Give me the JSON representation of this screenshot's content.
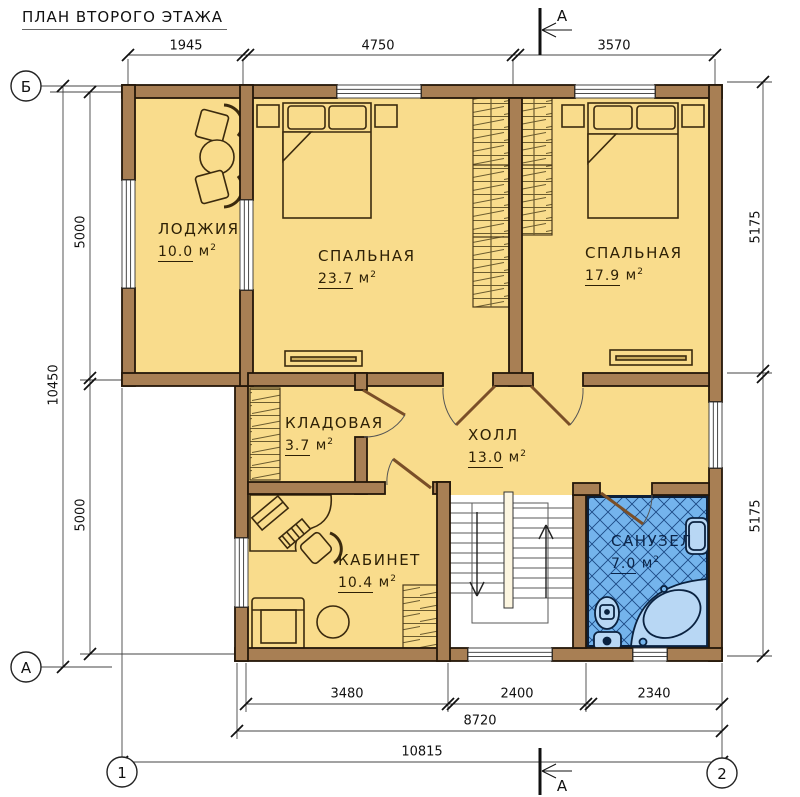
{
  "title": "ПЛАН ВТОРОГО ЭТАЖА",
  "rooms": {
    "loggia": {
      "name": "ЛОДЖИЯ",
      "area": "10.0"
    },
    "bedroom1": {
      "name": "СПАЛЬНАЯ",
      "area": "23.7"
    },
    "bedroom2": {
      "name": "СПАЛЬНАЯ",
      "area": "17.9"
    },
    "storeroom": {
      "name": "КЛАДОВАЯ",
      "area": "3.7"
    },
    "hall": {
      "name": "ХОЛЛ",
      "area": "13.0"
    },
    "office": {
      "name": "КАБИНЕТ",
      "area": "10.4"
    },
    "bathroom": {
      "name": "САНУЗЕЛ",
      "area": "7.0"
    }
  },
  "unit": {
    "base": "м",
    "sup": "2"
  },
  "dimensions": {
    "top": [
      "1945",
      "4750",
      "3570"
    ],
    "left": {
      "overall": "10450",
      "upper": "5000",
      "lower": "5000"
    },
    "right": {
      "upper": "5175",
      "lower": "5175"
    },
    "bottom": {
      "segments": [
        "3480",
        "2400",
        "2340"
      ],
      "subtotal": "8720",
      "overall": "10815"
    }
  },
  "axes": {
    "top_left": "Б",
    "bottom_left": "А",
    "col_left": "1",
    "col_right": "2"
  },
  "section": {
    "label": "А"
  },
  "colors": {
    "wall": "#a87f54",
    "floor": "#f9dc8c",
    "bath_floor": "#74b4ec",
    "outline": "#241709"
  }
}
